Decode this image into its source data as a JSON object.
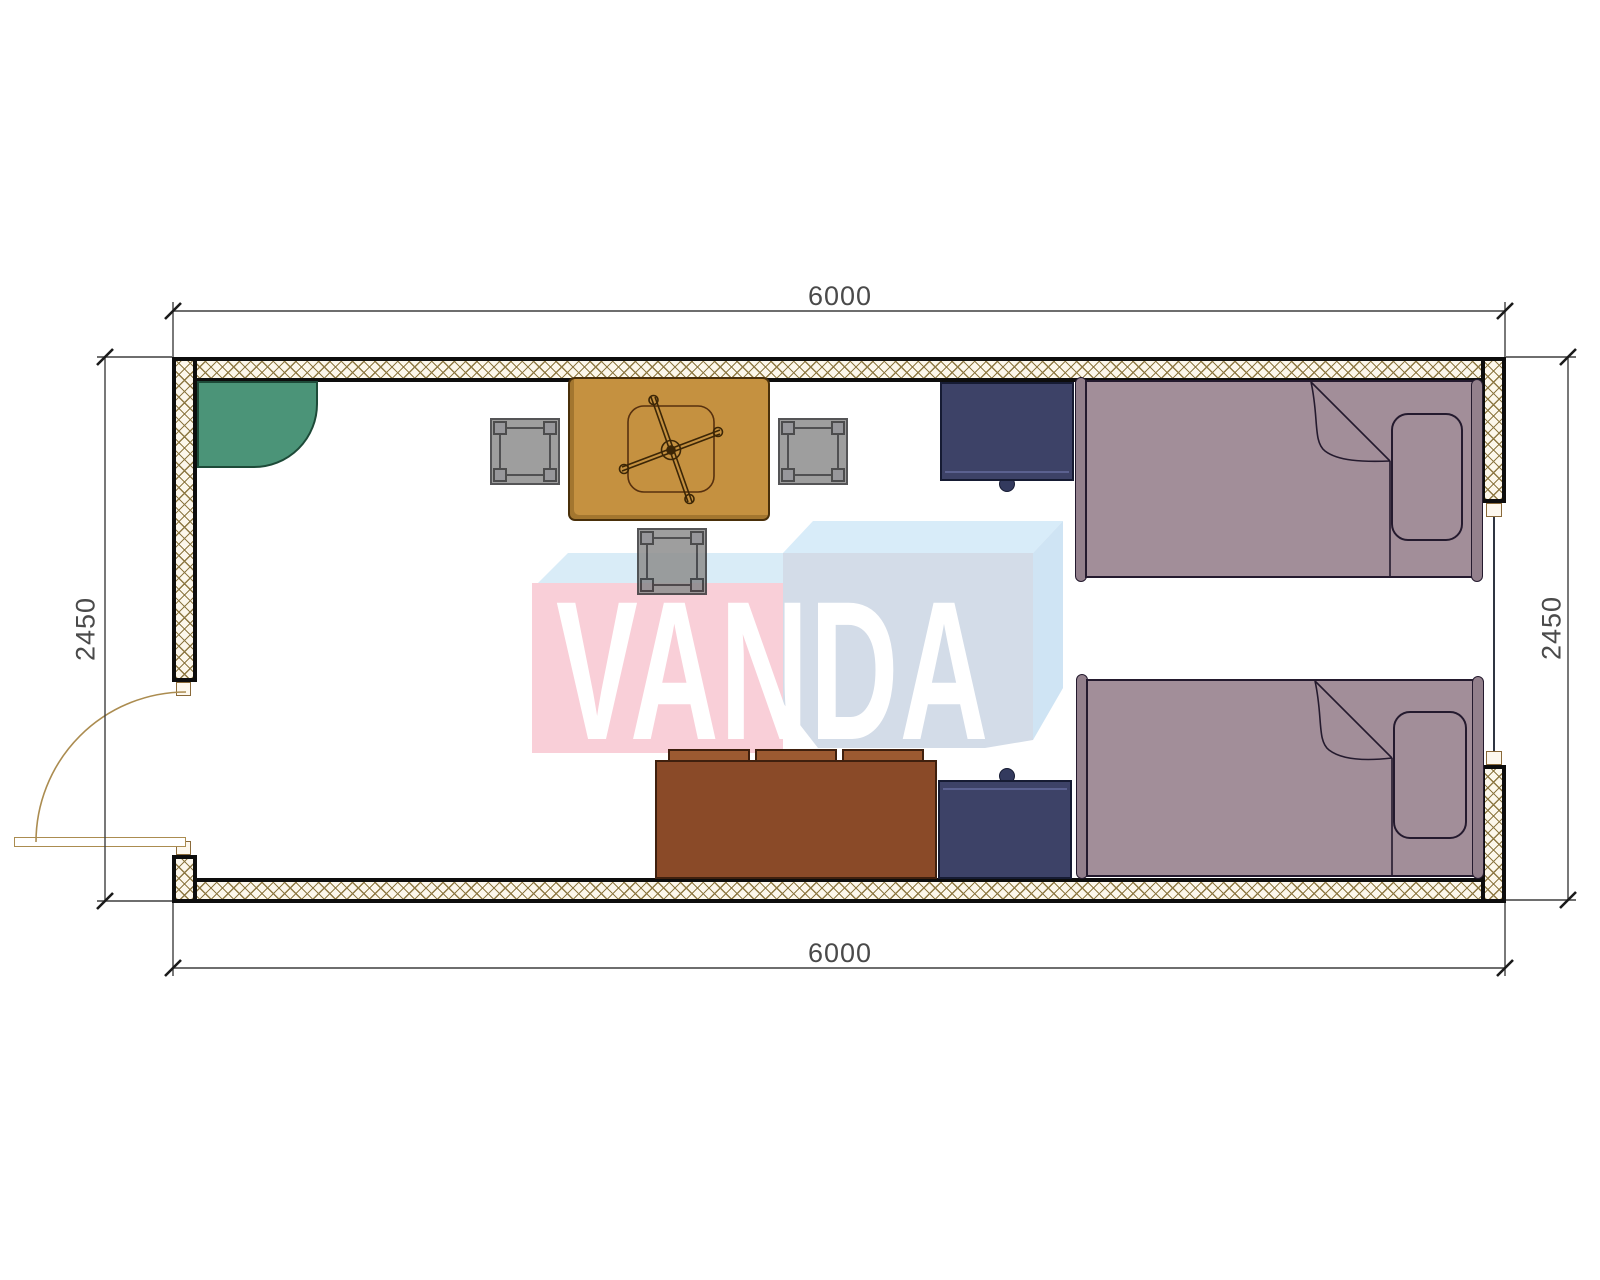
{
  "drawing": {
    "watermark_text": "VANDA",
    "dim_top": "6000",
    "dim_bottom": "6000",
    "dim_left": "2450",
    "dim_right": "2450"
  },
  "colors": {
    "wall_border": "#0d0d0d",
    "wall_hatch_bg": "#fcf7eb",
    "wall_hatch_line": "#8d7843",
    "green_corner_unit": "#4b9478",
    "table": "#c59140",
    "stool": "#8f8f8f",
    "sofa": "#8a4a28",
    "sofa_cushion": "#9c5a31",
    "nightstand": "#3d4267",
    "bed": "#a28e99",
    "door_arc": "#ab8c50",
    "window_glass": "#2f3542",
    "dimension_line": "#3f3f3f",
    "watermark_pink": "#f9cfd8",
    "watermark_pink_top": "#d9ecf7",
    "watermark_blue_top": "#d8ecf9",
    "watermark_blue_front": "#d3dce8",
    "watermark_blue_side": "#cfe4f4",
    "watermark_text_color": "#ffffff"
  },
  "symbols": {
    "corner_unit": "corner-basin",
    "table_symbol": "table-with-fan",
    "stool_count": "3",
    "bed_count": "2",
    "nightstand_count": "2",
    "door": "left-swing-door",
    "window": "right-wall-window"
  }
}
